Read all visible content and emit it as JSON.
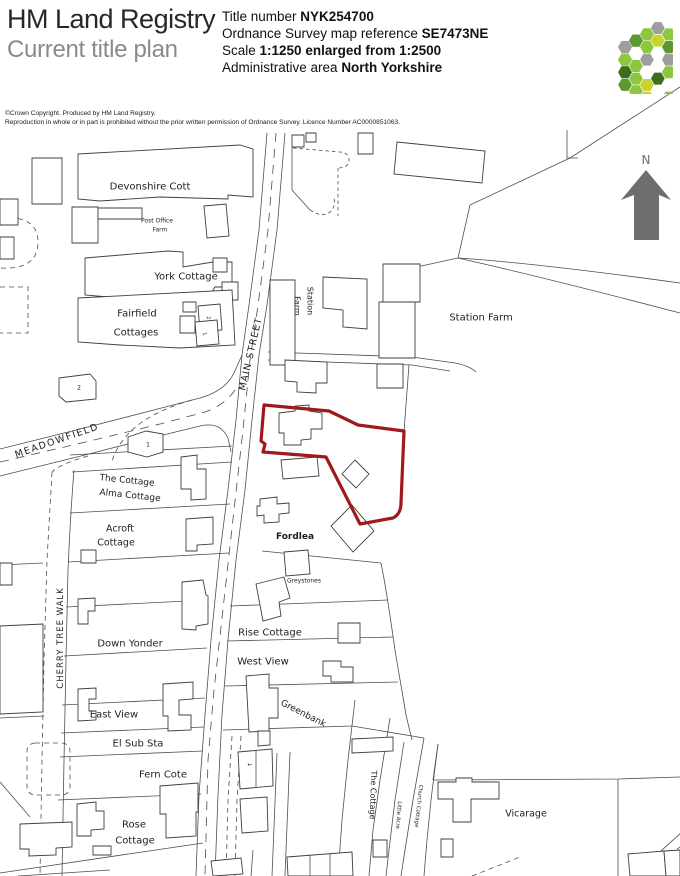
{
  "header": {
    "org": "HM Land Registry",
    "doc_type": "Current title plan",
    "fields": [
      {
        "label": "Title number ",
        "value": "NYK254700"
      },
      {
        "label": "Ordnance Survey map reference ",
        "value": "SE7473NE"
      },
      {
        "label": "Scale ",
        "value": "1:1250 enlarged from 1:2500"
      },
      {
        "label": "Administrative area ",
        "value": "North Yorkshire"
      }
    ]
  },
  "copyright": {
    "line1": "©Crown Copyright.  Produced by HM Land Registry.",
    "line2": "Reproduction in whole or in part is prohibited without the prior written permission of Ordnance Survey. Licence Number AC0000851063."
  },
  "colors": {
    "parcel_outline": "#a1181b",
    "map_line": "#4d4d4d",
    "compass_gray": "#6e6e6e"
  },
  "logo": {
    "palette": [
      "#8dc63f",
      "#5d9732",
      "#3f6d1e",
      "#c9d32e",
      "#9e9e9e",
      "#b5b5b5",
      "#ffffff",
      "#76a837"
    ],
    "cells": [
      6,
      2,
      0,
      4,
      0,
      3,
      1,
      0,
      3,
      1,
      4,
      0,
      2,
      3,
      0,
      1,
      0,
      4,
      1,
      4,
      0,
      1,
      3,
      4,
      0,
      2,
      1,
      0,
      4,
      3,
      0,
      1,
      2,
      0,
      4,
      1,
      0
    ]
  },
  "map": {
    "labels": [
      {
        "id": "devonshire-cott",
        "t": "Devonshire Cott",
        "x": 150,
        "y": 187,
        "s": 10
      },
      {
        "id": "post-office",
        "t": "Post Office",
        "x": 157,
        "y": 221,
        "s": 6
      },
      {
        "id": "post-office-farm",
        "t": "Farm",
        "x": 160,
        "y": 230,
        "s": 6
      },
      {
        "id": "york-cottage",
        "t": "York Cottage",
        "x": 186,
        "y": 277,
        "s": 10
      },
      {
        "id": "fairfield",
        "t": "Fairfield",
        "x": 137,
        "y": 314,
        "s": 10
      },
      {
        "id": "fairfield-cottages",
        "t": "Cottages",
        "x": 136,
        "y": 333,
        "s": 10
      },
      {
        "id": "meadowfield-road",
        "t": "MEADOWFIELD",
        "x": 57,
        "y": 441,
        "s": 9.5,
        "r": -19,
        "ls": 1.5
      },
      {
        "id": "main-street-road",
        "t": "MAIN STREET",
        "x": 251,
        "y": 354,
        "s": 9.5,
        "r": -77,
        "ls": 1
      },
      {
        "id": "station-1",
        "t": "Station",
        "x": 310,
        "y": 301,
        "s": 8,
        "r": 90
      },
      {
        "id": "station-2",
        "t": "Farm",
        "x": 297,
        "y": 306,
        "s": 8,
        "r": 90
      },
      {
        "id": "station-farm",
        "t": "Station Farm",
        "x": 481,
        "y": 318,
        "s": 10
      },
      {
        "id": "north-letter",
        "t": "N",
        "x": 646,
        "y": 160,
        "s": 12,
        "c": "#6e6e6e"
      },
      {
        "id": "plot-2",
        "t": "2",
        "x": 79,
        "y": 388,
        "s": 6
      },
      {
        "id": "plot-1",
        "t": "1",
        "x": 148,
        "y": 445,
        "s": 6
      },
      {
        "id": "plot-2b",
        "t": "2",
        "x": 208,
        "y": 318,
        "s": 5,
        "r": 82
      },
      {
        "id": "plot-1b",
        "t": "1",
        "x": 204,
        "y": 334,
        "s": 5,
        "r": 82
      },
      {
        "id": "the-cottage-w",
        "t": "The Cottage",
        "x": 127,
        "y": 481,
        "s": 9,
        "r": 6
      },
      {
        "id": "alma-cottage",
        "t": "Alma Cottage",
        "x": 130,
        "y": 496,
        "s": 9,
        "r": 6
      },
      {
        "id": "acroft",
        "t": "Acroft",
        "x": 120,
        "y": 529,
        "s": 9.5
      },
      {
        "id": "acroft-cottage",
        "t": "Cottage",
        "x": 116,
        "y": 543,
        "s": 9.5
      },
      {
        "id": "fordlea",
        "t": "Fordlea",
        "x": 295,
        "y": 537,
        "s": 9,
        "b": 1
      },
      {
        "id": "greystones",
        "t": "Greystones",
        "x": 304,
        "y": 581,
        "s": 6
      },
      {
        "id": "rise-cottage",
        "t": "Rise Cottage",
        "x": 270,
        "y": 633,
        "s": 10
      },
      {
        "id": "west-view",
        "t": "West View",
        "x": 263,
        "y": 662,
        "s": 10
      },
      {
        "id": "down-yonder",
        "t": "Down Yonder",
        "x": 130,
        "y": 644,
        "s": 10
      },
      {
        "id": "cherry-tree-walk",
        "t": "CHERRY TREE WALK",
        "x": 61,
        "y": 638,
        "s": 8.5,
        "r": -90,
        "ls": 1
      },
      {
        "id": "east-view",
        "t": "East View",
        "x": 114,
        "y": 715,
        "s": 10
      },
      {
        "id": "el-sub-sta",
        "t": "El Sub Sta",
        "x": 138,
        "y": 744,
        "s": 10
      },
      {
        "id": "fern-cote",
        "t": "Fern Cote",
        "x": 163,
        "y": 775,
        "s": 10
      },
      {
        "id": "rose",
        "t": "Rose",
        "x": 134,
        "y": 825,
        "s": 10
      },
      {
        "id": "rose-cottage",
        "t": "Cottage",
        "x": 135,
        "y": 841,
        "s": 10
      },
      {
        "id": "greenbank",
        "t": "Greenbank",
        "x": 303,
        "y": 714,
        "s": 9,
        "r": 27
      },
      {
        "id": "the-cottage-s",
        "t": "The Cottage",
        "x": 373,
        "y": 795,
        "s": 8,
        "r": 92
      },
      {
        "id": "little-acre",
        "t": "Little Acre",
        "x": 398,
        "y": 815,
        "s": 5.5,
        "r": 94
      },
      {
        "id": "church-cottage",
        "t": "Church Cottage",
        "x": 418,
        "y": 806,
        "s": 5.5,
        "r": 96
      },
      {
        "id": "vicarage",
        "t": "Vicarage",
        "x": 526,
        "y": 814,
        "s": 9.5
      },
      {
        "id": "bench-mark-1",
        "t": "←",
        "x": 250,
        "y": 765,
        "s": 6
      },
      {
        "id": "bench-mark-2",
        "t": "247",
        "x": -500,
        "y": -500,
        "s": 1
      }
    ]
  }
}
